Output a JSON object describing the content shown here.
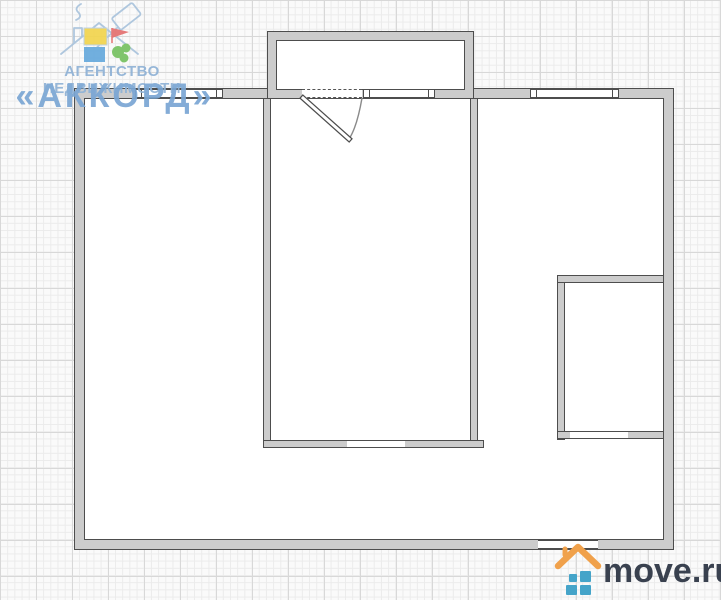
{
  "watermarks": {
    "agency": {
      "line1": "АГЕНТСТВО НЕДВИЖИМОСТИ",
      "line2": "«АККОРД»",
      "text_color": "#8fb2d6",
      "accent_color": "#7aa6d4",
      "icon_colors": {
        "outline": "#a9c3dc",
        "yellow": "#f2d54e",
        "red": "#e47070",
        "blue": "#66a9dc",
        "green": "#76c161"
      }
    },
    "portal": {
      "text": "move.ru",
      "text_color": "#39414f",
      "roof_color": "#f0a14b",
      "squares_color": "#45a4c9"
    }
  },
  "colors": {
    "background": "#fafafa",
    "grid_minor": "#ebebeb",
    "grid_major": "#d8d8d8",
    "wall_fill": "#cccccc",
    "wall_stroke": "#4d4d4d",
    "room_fill": "#ffffff"
  },
  "floor_plan": {
    "outer": {
      "x": 75,
      "y": 89,
      "w": 598,
      "h": 460,
      "t": 9
    },
    "balcony": {
      "x": 268,
      "y": 32,
      "w": 205,
      "h": 66,
      "t": 8
    },
    "walls": [
      {
        "name": "living-room-wall-left",
        "x": 263,
        "y": 98,
        "w": 8,
        "h": 350
      },
      {
        "name": "living-room-wall-right",
        "x": 470,
        "y": 98,
        "w": 8,
        "h": 350
      },
      {
        "name": "living-room-wall-bottom",
        "x": 263,
        "y": 440,
        "w": 221,
        "h": 8
      },
      {
        "name": "bathroom-wall-left",
        "x": 557,
        "y": 275,
        "w": 8,
        "h": 165
      },
      {
        "name": "bathroom-wall-top",
        "x": 557,
        "y": 275,
        "w": 107,
        "h": 8
      },
      {
        "name": "bathroom-wall-bottom",
        "x": 557,
        "y": 431,
        "w": 107,
        "h": 8
      }
    ],
    "windows": [
      {
        "name": "window-top-left",
        "x": 137,
        "y": 89,
        "w": 84,
        "h": 9
      },
      {
        "name": "balcony-window",
        "x": 365,
        "y": 89,
        "w": 68,
        "h": 9
      },
      {
        "name": "window-top-right",
        "x": 532,
        "y": 89,
        "w": 85,
        "h": 9
      }
    ],
    "openings": [
      {
        "name": "balcony-door-opening",
        "x": 302,
        "y": 89,
        "w": 60,
        "h": 9,
        "dashed": true
      },
      {
        "name": "living-room-doorway",
        "x": 347,
        "y": 440,
        "w": 58,
        "h": 8
      },
      {
        "name": "bathroom-doorway",
        "x": 570,
        "y": 431,
        "w": 58,
        "h": 8
      },
      {
        "name": "entrance-opening",
        "x": 538,
        "y": 540,
        "w": 60,
        "h": 9
      }
    ],
    "door_swing": {
      "hinge": [
        303,
        98
      ],
      "tip": [
        349,
        139
      ],
      "arc_start": [
        362,
        98
      ]
    }
  }
}
